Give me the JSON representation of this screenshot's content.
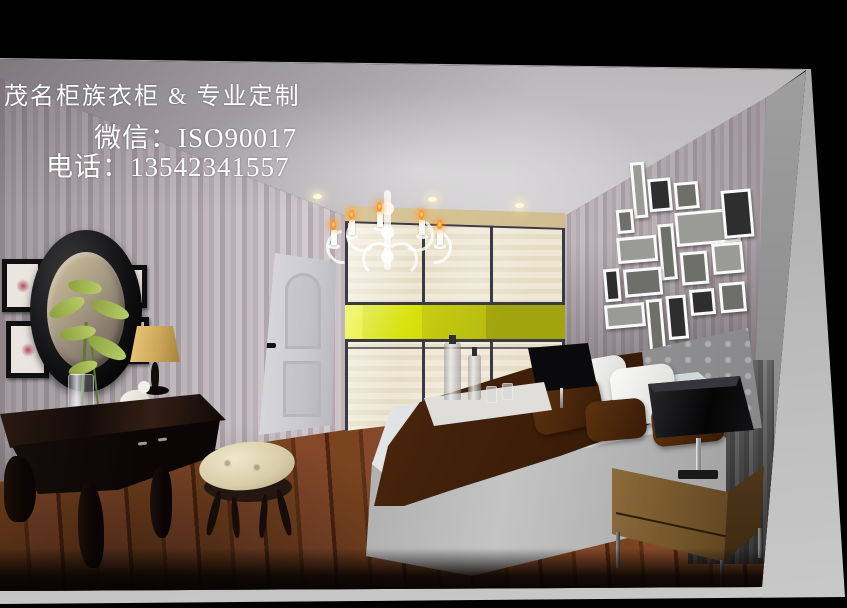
{
  "meta": {
    "type": "promotional-interior-render",
    "subject": "bedroom with sliding-door wardrobe"
  },
  "overlay": {
    "line1": "茂名柜族衣柜 & 专业定制",
    "line2": "微信：ISO90017",
    "line3": "电话：13542341557",
    "text_color": "#ffffff"
  },
  "scene": {
    "colors": {
      "canvas_black": "#000000",
      "mat_gray": "#b5b5b5",
      "ceiling_light": "#d8d8da",
      "wallpaper_stripe_light": "#cdc5ca",
      "wallpaper_stripe_dark": "#b4aab0",
      "wardrobe_panel_cream": "#ebe3cf",
      "wardrobe_accent_yellow": "#d8e20c",
      "wardrobe_accent_olive": "#b2b60f",
      "wardrobe_frame_line": "#3a3a44",
      "valance_beige": "#d8c9a2",
      "floor_wood_brown": "#6e3a1d",
      "bed_base_gray": "#a9a9a9",
      "linen_white": "#f2f3f3",
      "duvet_brown": "#4a2408",
      "headboard_gray": "#a2a2a4",
      "nightstand_wood": "#8a6a3a",
      "lamp_shade_black": "#0c0c0e",
      "lamp_shade_tan": "#cda75b",
      "stool_cream": "#d8cda8",
      "door_white": "#d6d6d9",
      "plant_green": "#9cb54e",
      "candle_flame_orange": "#ff8c1a"
    },
    "objects": [
      "ceiling spotlights",
      "white ornate chandelier with candles",
      "three-panel sliding wardrobe with yellow accent band",
      "white arched-panel door",
      "oval black-framed mirror",
      "green flowers in glass vase",
      "tan-shade table lamp",
      "white bird figurine",
      "dark wood dressing table",
      "cream tufted stool",
      "white picture-frame gallery wall",
      "gray upholstered bed with brown duvet and pillows",
      "white serving tray with bottles and glasses",
      "black square-shade table lamps",
      "light wood nightstand",
      "striped wallpaper",
      "hardwood plank floor",
      "gray curtain panel"
    ]
  }
}
